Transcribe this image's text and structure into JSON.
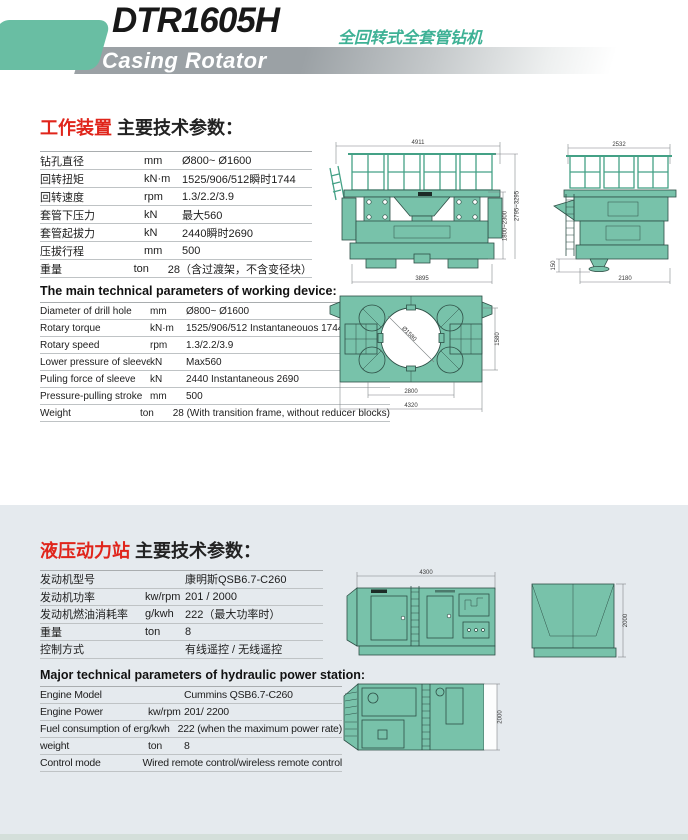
{
  "header": {
    "model": "DTR1605H",
    "subtitle_cn": "全回转式全套管钻机",
    "subtitle_en": "Casing Rotator"
  },
  "colors": {
    "accent_teal": "#69bea3",
    "drawing_green": "#78c2aa",
    "title_red": "#e0251b",
    "band_gray": "#9ba1a5",
    "section2_bg": "#e5eaee"
  },
  "section_working": {
    "title_cn_red": "工作装置",
    "title_cn_rest": " 主要技术参数：",
    "table_cn": {
      "rows": [
        {
          "label": "钻孔直径",
          "unit": "mm",
          "value": "Ø800~ Ø1600"
        },
        {
          "label": "回转扭矩",
          "unit": "kN·m",
          "value": "1525/906/512瞬时1744"
        },
        {
          "label": "回转速度",
          "unit": "rpm",
          "value": "1.3/2.2/3.9"
        },
        {
          "label": "套管下压力",
          "unit": "kN",
          "value": "最大560"
        },
        {
          "label": "套管起拔力",
          "unit": "kN",
          "value": "2440瞬时2690"
        },
        {
          "label": "压拔行程",
          "unit": "mm",
          "value": "500"
        },
        {
          "label": "重量",
          "unit": "ton",
          "value": "28（含过渡架，不含变径块）"
        }
      ]
    },
    "title_en": "The main technical parameters of working device:",
    "table_en": {
      "rows": [
        {
          "label": "Diameter of drill hole",
          "unit": "mm",
          "value": "Ø800~ Ø1600"
        },
        {
          "label": "Rotary torque",
          "unit": "kN·m",
          "value": "1525/906/512 Instantaneouos 1744"
        },
        {
          "label": "Rotary speed",
          "unit": "rpm",
          "value": "1.3/2.2/3.9"
        },
        {
          "label": "Lower pressure of sleeve",
          "unit": "kN",
          "value": "Max560"
        },
        {
          "label": "Puling force of sleeve",
          "unit": "kN",
          "value": "2440 Instantaneous 2690"
        },
        {
          "label": "Pressure-pulling stroke",
          "unit": "mm",
          "value": "500"
        },
        {
          "label": "Weight",
          "unit": "ton",
          "value": "28  (With transition frame, without reducer blocks)"
        }
      ]
    },
    "drawings": {
      "front": {
        "dim_top": "4911",
        "dim_bottom": "3895",
        "dim_right_inner": "1800~2300",
        "dim_right_outer": "2795~3295"
      },
      "side": {
        "dim_top": "2532",
        "dim_bottom": "2180",
        "dim_left": "150"
      },
      "plan": {
        "dim_circle": "Ø1580",
        "dim_right": "1580",
        "dim_bottom_inner": "2800",
        "dim_bottom_outer": "4320"
      }
    }
  },
  "section_power": {
    "title_cn_red": "液压动力站",
    "title_cn_rest": " 主要技术参数：",
    "table_cn": {
      "rows": [
        {
          "label": "发动机型号",
          "unit": "",
          "value": "康明斯QSB6.7-C260"
        },
        {
          "label": "发动机功率",
          "unit": "kw/rpm",
          "value": "201 / 2000"
        },
        {
          "label": "发动机燃油消耗率",
          "unit": "g/kwh",
          "value": "222（最大功率时）"
        },
        {
          "label": "重量",
          "unit": "ton",
          "value": "8"
        },
        {
          "label": "控制方式",
          "unit": "",
          "value": "有线遥控 / 无线遥控"
        }
      ]
    },
    "title_en": "Major technical parameters of hydraulic power station:",
    "table_en": {
      "rows": [
        {
          "label": "Engine Model",
          "unit": "",
          "value": "Cummins QSB6.7-C260"
        },
        {
          "label": "Engine Power",
          "unit": "kw/rpm",
          "value": "201/ 2200"
        },
        {
          "label": "Fuel consumption of engine",
          "unit": "g/kwh",
          "value": "222 (when the maximum power rate)"
        },
        {
          "label": "weight",
          "unit": "ton",
          "value": "8"
        },
        {
          "label": "Control mode",
          "unit": "",
          "value": "Wired remote control/wireless remote control"
        }
      ]
    },
    "drawings": {
      "container_side": {
        "dim_top": "4300"
      },
      "container_end": {
        "dim_right": "2000"
      },
      "container_plan": {
        "dim_right": "2000"
      }
    }
  }
}
